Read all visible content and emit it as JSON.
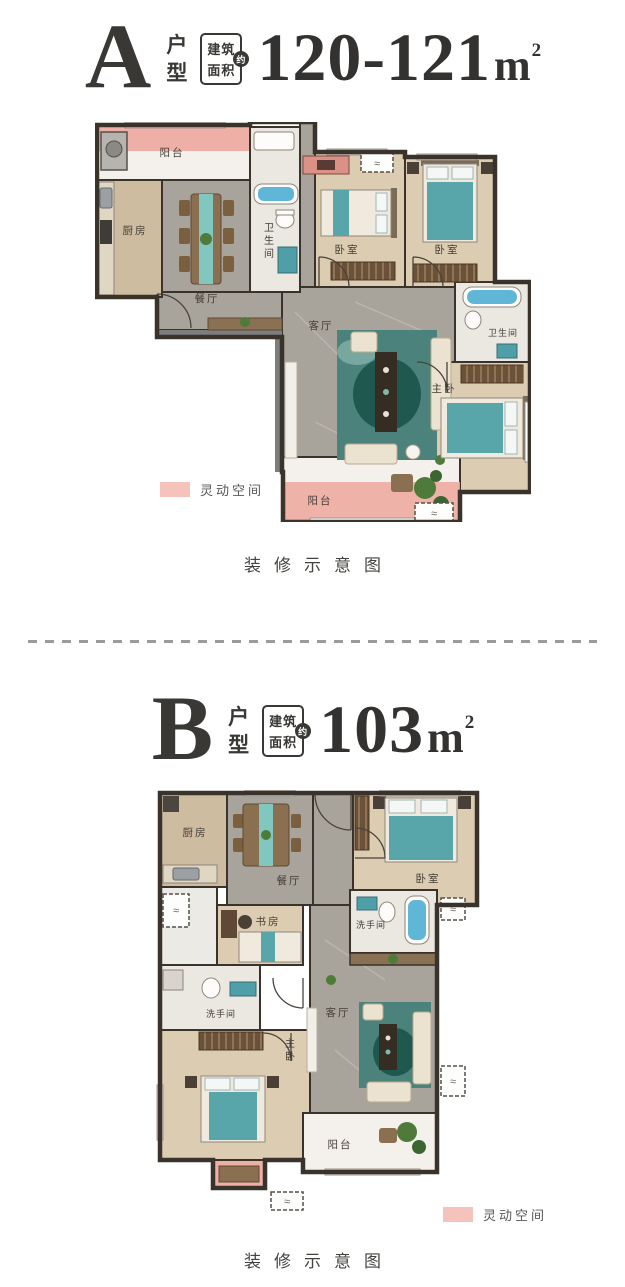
{
  "page": {
    "background": "#ffffff"
  },
  "icons": {
    "ac_symbol": "≈"
  },
  "legend": {
    "swatch_color": "#f6c2bc"
  },
  "plan_a": {
    "type_letter": "A",
    "type_label_chars": {
      "first": "户",
      "second": "型"
    },
    "badge": {
      "line1": "建筑",
      "line2": "面积",
      "circle": "约"
    },
    "area": {
      "value": "120-121",
      "unit": "m",
      "sup": "2"
    },
    "rooms": {
      "balcony_top": "阳台",
      "kitchen": "厨房",
      "dining": "餐厅",
      "bath1": "卫生间",
      "bedroom1": "卧室",
      "bedroom2": "卧室",
      "living": "客厅",
      "bath2": "卫生间",
      "master": "主卧",
      "balcony_bottom": "阳台"
    },
    "legend_label": "灵动空间",
    "caption": "装修示意图"
  },
  "plan_b": {
    "type_letter": "B",
    "type_label_chars": {
      "first": "户",
      "second": "型"
    },
    "badge": {
      "line1": "建筑",
      "line2": "面积",
      "circle": "约"
    },
    "area": {
      "value": "103",
      "unit": "m",
      "sup": "2"
    },
    "rooms": {
      "kitchen": "厨房",
      "dining": "餐厅",
      "bedroom": "卧室",
      "study": "书房",
      "washroom_top": "洗手间",
      "washroom_left": "洗手间",
      "master": "主卧",
      "living": "客厅",
      "balcony": "阳台"
    },
    "legend_label": "灵动空间",
    "caption": "装修示意图"
  }
}
